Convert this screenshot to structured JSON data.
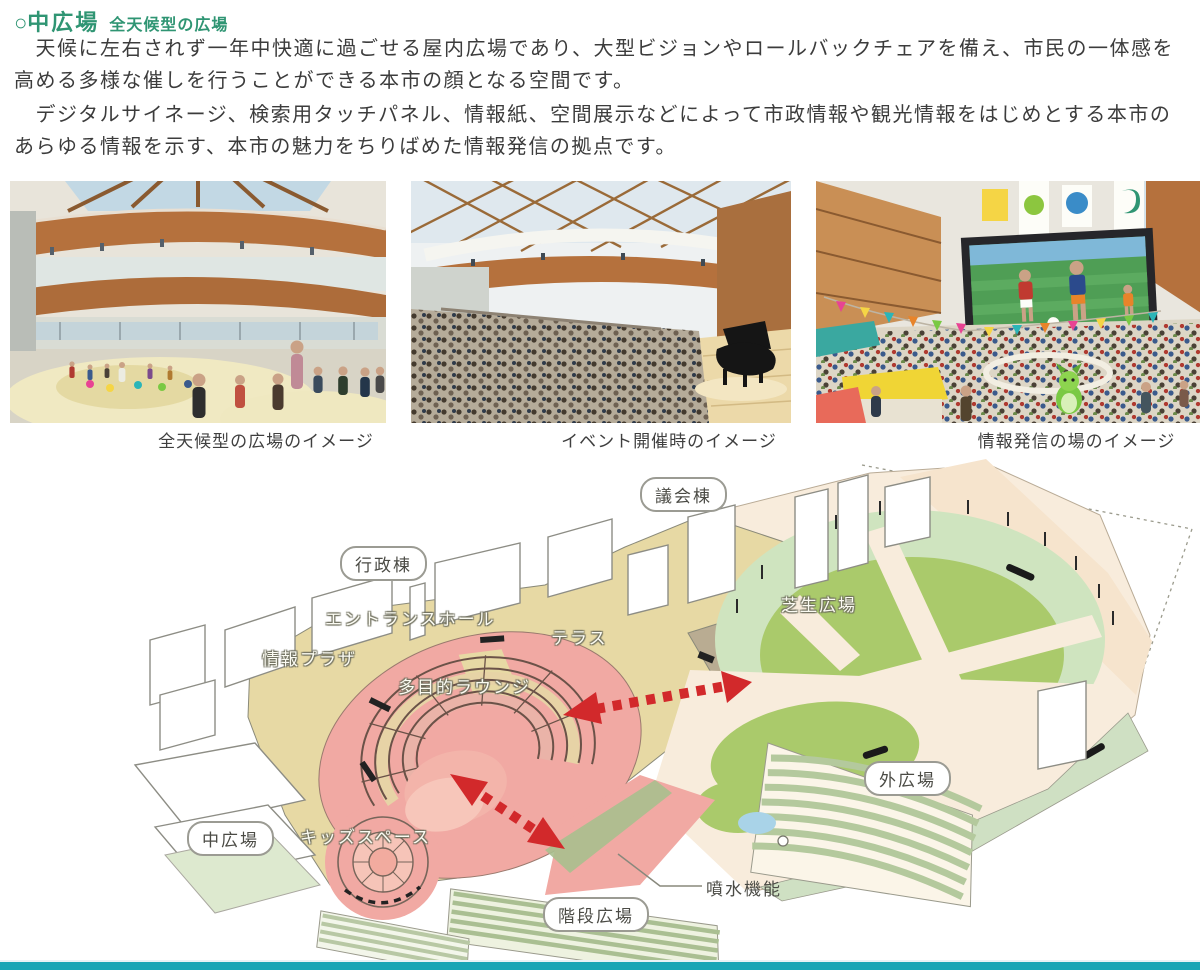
{
  "page": {
    "header": {
      "marker": "○",
      "title": "中広場",
      "subtitle": "全天候型の広場"
    },
    "paragraphs": [
      "　天候に左右されず一年中快適に過ごせる屋内広場であり、大型ビジョンやロールバックチェアを備え、市民の一体感を高める多様な催しを行うことができる本市の顔となる空間です。",
      "　デジタルサイネージ、検索用タッチパネル、情報紙、空間展示などによって市政情報や観光情報をはじめとする本市のあらゆる情報を示す、本市の魅力をちりばめた情報発信の拠点です。"
    ]
  },
  "photos": [
    {
      "caption": "全天候型の広場のイメージ"
    },
    {
      "caption": "イベント開催時のイメージ"
    },
    {
      "caption": "情報発信の場のイメージ"
    }
  ],
  "siteplan": {
    "labels": {
      "council_building": "議会棟",
      "admin_building": "行政棟",
      "entrance_hall": "エントランスホール",
      "terrace": "テラス",
      "info_plaza": "情報プラザ",
      "multipurpose_lounge": "多目的ラウンジ",
      "lawn_plaza": "芝生広場",
      "outer_plaza": "外広場",
      "central_plaza": "中広場",
      "kids_space": "キッズスペース",
      "fountain_feature": "噴水機能",
      "stair_plaza": "階段広場"
    }
  },
  "colors": {
    "heading_green": "#2f9573",
    "body_text": "#3c3c3c",
    "floor_tan": "#e7d9a4",
    "plaza_pink": "#f1a9a3",
    "lawn_green": "#aaca6b",
    "colonnade_green": "#cfe4bf",
    "path_cream": "#f8ecdc",
    "arrow_red": "#d2292b",
    "pond_blue": "#a9d3e8",
    "footer_teal": "#18a6b5"
  }
}
